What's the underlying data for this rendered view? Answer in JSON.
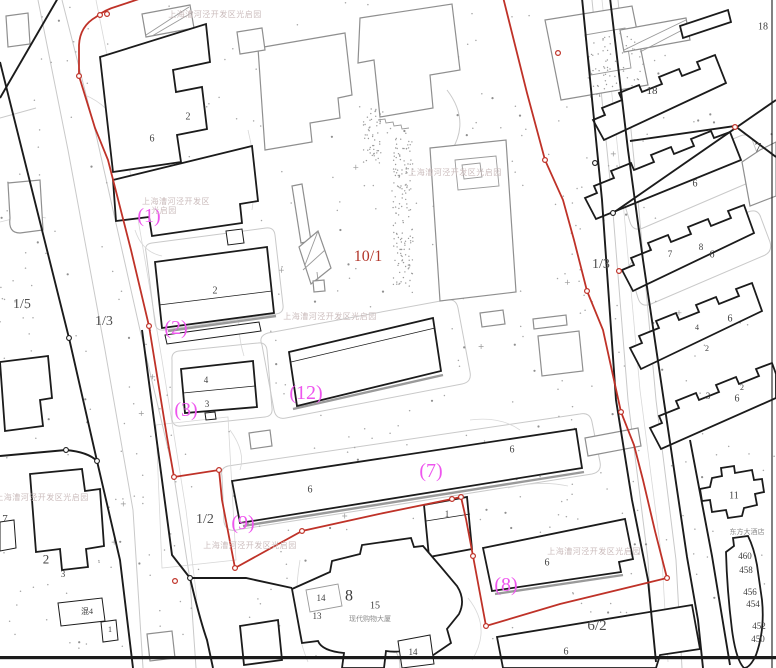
{
  "map": {
    "colors": {
      "boundary_red": "#bf3228",
      "label_magenta": "#ee55ee",
      "parcel_red_text": "#b23529",
      "ink_black": "#1b1b1b",
      "gray_building": "#8f8f8f",
      "light_line": "#c9c9c9",
      "watermark_gray": "#cbbcbc",
      "gray_text": "#4f4f4f"
    },
    "watermark_full": "上海漕河泾开发区光启园",
    "watermark_line1": "上海漕河泾开发区",
    "watermark_line2": "光启园",
    "watermarks": [
      {
        "x": 215,
        "y": 14,
        "wrap": false
      },
      {
        "x": 176,
        "y": 201,
        "wrap": true
      },
      {
        "x": 455,
        "y": 172,
        "wrap": false
      },
      {
        "x": 330,
        "y": 316,
        "wrap": false
      },
      {
        "x": 250,
        "y": 545,
        "wrap": false
      },
      {
        "x": 594,
        "y": 551,
        "wrap": false
      },
      {
        "x": 42,
        "y": 497,
        "wrap": false
      }
    ],
    "boundary_point_labels": [
      {
        "text": "(1)",
        "x": 149,
        "y": 215
      },
      {
        "text": "(2)",
        "x": 176,
        "y": 327
      },
      {
        "text": "(3)",
        "x": 186,
        "y": 409
      },
      {
        "text": "(12)",
        "x": 306,
        "y": 392
      },
      {
        "text": "(9)",
        "x": 243,
        "y": 522
      },
      {
        "text": "(7)",
        "x": 431,
        "y": 470
      },
      {
        "text": "(8)",
        "x": 506,
        "y": 584
      }
    ],
    "parcel_labels": [
      {
        "text": "10/1",
        "x": 368,
        "y": 256,
        "red": true,
        "size": 16
      },
      {
        "text": "1/5",
        "x": 22,
        "y": 303,
        "red": false,
        "size": 14
      },
      {
        "text": "1/3",
        "x": 104,
        "y": 320,
        "red": false,
        "size": 14
      },
      {
        "text": "1/3",
        "x": 601,
        "y": 263,
        "red": false,
        "size": 14
      },
      {
        "text": "1/2",
        "x": 205,
        "y": 518,
        "red": false,
        "size": 14
      },
      {
        "text": "6/2",
        "x": 597,
        "y": 625,
        "red": false,
        "size": 15
      }
    ],
    "building_numbers": [
      {
        "text": "2",
        "x": 188,
        "y": 116,
        "size": 10
      },
      {
        "text": "6",
        "x": 152,
        "y": 138,
        "size": 10
      },
      {
        "text": "2",
        "x": 215,
        "y": 290,
        "size": 10
      },
      {
        "text": "4",
        "x": 206,
        "y": 380,
        "size": 9
      },
      {
        "text": "3",
        "x": 207,
        "y": 404,
        "size": 9
      },
      {
        "text": "6",
        "x": 310,
        "y": 489,
        "size": 10
      },
      {
        "text": "6",
        "x": 512,
        "y": 449,
        "size": 10
      },
      {
        "text": "6",
        "x": 547,
        "y": 562,
        "size": 10
      },
      {
        "text": "1",
        "x": 447,
        "y": 514,
        "size": 9
      },
      {
        "text": "8",
        "x": 349,
        "y": 595,
        "size": 16
      },
      {
        "text": "15",
        "x": 375,
        "y": 605,
        "size": 10
      },
      {
        "text": "14",
        "x": 321,
        "y": 598,
        "size": 9
      },
      {
        "text": "13",
        "x": 317,
        "y": 616,
        "size": 9
      },
      {
        "text": "14",
        "x": 413,
        "y": 652,
        "size": 9
      },
      {
        "text": "6",
        "x": 566,
        "y": 651,
        "size": 10
      },
      {
        "text": "2",
        "x": 46,
        "y": 559,
        "size": 13
      },
      {
        "text": "3",
        "x": 63,
        "y": 574,
        "size": 9
      },
      {
        "text": "混4",
        "x": 87,
        "y": 611,
        "size": 8
      },
      {
        "text": "1",
        "x": 110,
        "y": 629,
        "size": 8
      },
      {
        "text": "7",
        "x": 5,
        "y": 518,
        "size": 11
      },
      {
        "text": "18",
        "x": 652,
        "y": 90,
        "size": 11
      },
      {
        "text": "18",
        "x": 763,
        "y": 26,
        "size": 10
      },
      {
        "text": "7",
        "x": 758,
        "y": 147,
        "size": 13
      },
      {
        "text": "6",
        "x": 695,
        "y": 183,
        "size": 10
      },
      {
        "text": "7",
        "x": 670,
        "y": 254,
        "size": 9
      },
      {
        "text": "8",
        "x": 701,
        "y": 247,
        "size": 9
      },
      {
        "text": "6",
        "x": 712,
        "y": 254,
        "size": 10
      },
      {
        "text": "6",
        "x": 730,
        "y": 318,
        "size": 10
      },
      {
        "text": "4",
        "x": 697,
        "y": 327,
        "size": 8
      },
      {
        "text": "2",
        "x": 707,
        "y": 348,
        "size": 8
      },
      {
        "text": "3",
        "x": 708,
        "y": 396,
        "size": 9
      },
      {
        "text": "2",
        "x": 742,
        "y": 387,
        "size": 8
      },
      {
        "text": "6",
        "x": 737,
        "y": 398,
        "size": 10
      },
      {
        "text": "11",
        "x": 734,
        "y": 495,
        "size": 10
      },
      {
        "text": "460",
        "x": 745,
        "y": 556,
        "size": 9
      },
      {
        "text": "458",
        "x": 746,
        "y": 570,
        "size": 9
      },
      {
        "text": "456",
        "x": 750,
        "y": 592,
        "size": 9
      },
      {
        "text": "454",
        "x": 753,
        "y": 604,
        "size": 9
      },
      {
        "text": "452",
        "x": 759,
        "y": 626,
        "size": 9
      },
      {
        "text": "450",
        "x": 758,
        "y": 639,
        "size": 9
      }
    ],
    "small_texts": [
      {
        "text": "现代购物大厦",
        "x": 370,
        "y": 618,
        "size": 7
      },
      {
        "text": "东方大酒店",
        "x": 747,
        "y": 531,
        "size": 7
      }
    ]
  }
}
